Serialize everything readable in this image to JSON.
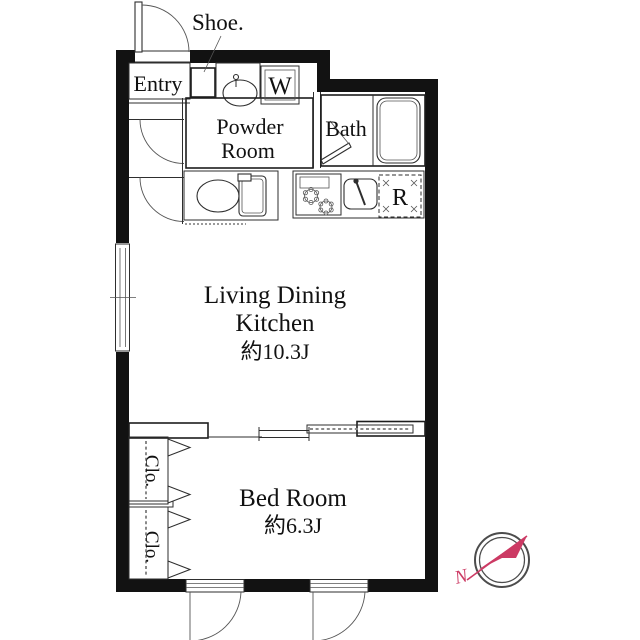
{
  "plan": {
    "entry": {
      "label": "Entry"
    },
    "shoe": {
      "label": "Shoe."
    },
    "powder_room": {
      "line1": "Powder",
      "line2": "Room"
    },
    "bath": {
      "label": "Bath"
    },
    "washer_space": {
      "label": "W"
    },
    "fridge_space": {
      "label": "R"
    },
    "ldk": {
      "line1": "Living Dining",
      "line2": "Kitchen",
      "size": "約10.3J"
    },
    "bedroom": {
      "label": "Bed Room",
      "size": "約6.3J"
    },
    "closet_upper": {
      "label": "Clo."
    },
    "closet_lower": {
      "label": "Clo."
    }
  },
  "compass": {
    "north_label": "N"
  },
  "colors": {
    "wall": "#121212",
    "compass_ring": "#4c4c4c",
    "compass_accent": "#cc3a64"
  }
}
